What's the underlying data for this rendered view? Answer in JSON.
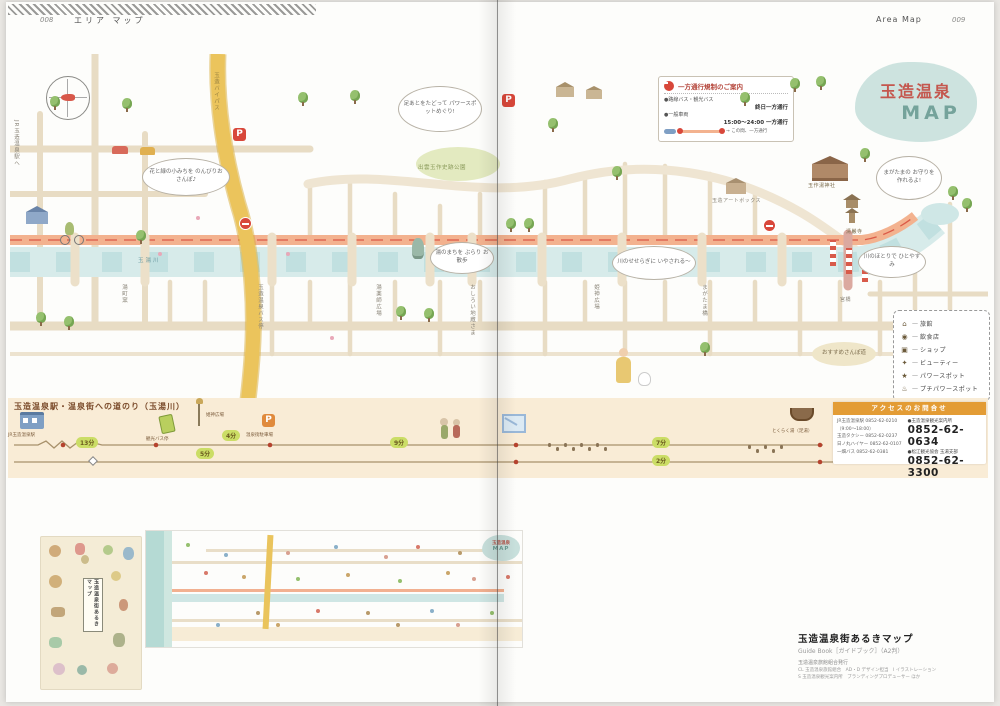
{
  "page_header": {
    "left_folio": "008",
    "left_section": "エリア マップ",
    "right_section": "Area Map",
    "right_folio": "009"
  },
  "map": {
    "title_top": "玉造温泉",
    "title_bottom": "MAP",
    "p_label": "P",
    "oneway": {
      "title": "一方通行規制のご案内",
      "row1_label": "●路線バス・観光バス",
      "row1_value": "終日一方通行",
      "row2_label": "●一般車両",
      "row2_value": "15:00〜24:00 一方通行",
      "note": "→ この間、一方通行"
    },
    "legend": {
      "items": [
        {
          "label": "旅館"
        },
        {
          "label": "飲食店"
        },
        {
          "label": "ショップ"
        },
        {
          "label": "ビューティー"
        },
        {
          "label": "パワースポット"
        },
        {
          "label": "プチパワースポット"
        }
      ]
    },
    "park_label": "出雲玉作史跡公園",
    "bubbles": {
      "b1": "花と緑の小みちを のんびりおさんぽ♪",
      "b2": "足あとをたどって パワースポットめぐり!",
      "b3": "湯のまちを ぶらり お散歩",
      "b4": "川のせせらぎに いやされる〜",
      "b5": "まがたまの お守りを 作れるよ!",
      "b6": "川のほとりで ひとやすみ",
      "b7": "おすすめさんぽ道"
    },
    "labels": {
      "shrine": "玉作湯神社",
      "temple": "清巌寺",
      "miyabashi": "宮橋",
      "river": "玉湯川",
      "yuyakushi": "湯薬師広場",
      "himegami": "姫神広場",
      "jizo": "おしろい地蔵さま",
      "kiln": "湯町窯",
      "busstop": "玉造温泉バス停",
      "magatama_bridge": "まがたま橋",
      "artbox": "玉造アートボックス",
      "to_station": "JR玉造温泉駅へ",
      "bypass": "玉造バイパス"
    }
  },
  "route": {
    "title": "玉造温泉駅・温泉街への道のり（玉湯川）",
    "station": "JR玉造温泉駅",
    "bus_sign": "観光バス停",
    "himegami": "姫神広場",
    "parking": "温泉街駐車場",
    "ashiyu": "とくらく湯（足湯）",
    "t13": "13分",
    "t4": "4分",
    "t5": "5分",
    "t9": "9分",
    "t7": "7分",
    "t2": "2分"
  },
  "access": {
    "header": "アクセスのお問合せ",
    "l1": "JR玉造温泉駅 0852-62-0210",
    "l2": "（9:00〜18:00）",
    "l3": "玉造タクシー 0852-62-0237",
    "l4": "日ノ丸ハイヤー 0852-62-0107",
    "l5": "一畑バス 0852-62-0381",
    "r1_label": "●玉造温泉観光案内所",
    "r1_phone": "0852-62-0634",
    "r2_label": "●松江観光協会 玉湯支部",
    "r2_phone": "0852-62-3300"
  },
  "booklet": {
    "cover_title": "玉造温泉街あるきマップ",
    "mini_logo_top": "玉造温泉",
    "mini_logo_bottom": "MAP"
  },
  "caption": {
    "title": "玉造温泉街あるきマップ",
    "subtitle": "Guide Book［ガイドブック］（A2判）",
    "publisher": "玉造温泉旅館組合発行",
    "credits1": "CL 玉造温泉旅館組合　AD・D デザイン担当　I イラストレーション",
    "credits2": "S 玉造温泉観光案内所　ブランディングプロデューサー ほか"
  }
}
